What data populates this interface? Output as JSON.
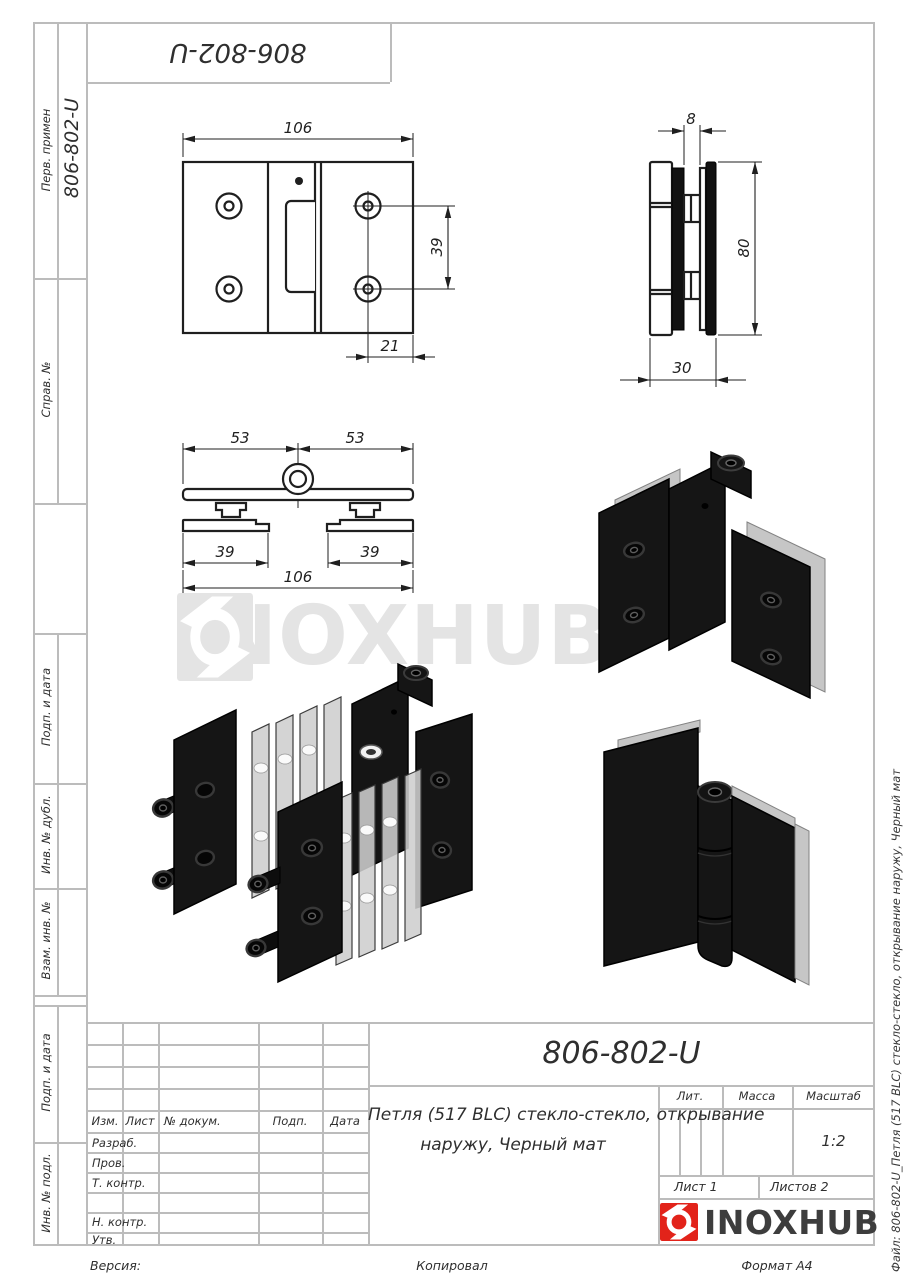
{
  "document": {
    "top_stamp": "806-802-U",
    "side_stamp": "806-802-U",
    "title_number": "806-802-U",
    "description_line1": "Петля (517 BLC) стекло-стекло, открывание",
    "description_line2": "наружу, Черный мат",
    "file_note": "Файл: 806-802-U_Петля (517 BLC) стекло-стекло, открывание наружу, Черный мат",
    "version_label": "Версия:",
    "copied_label": "Копировал",
    "format_label": "Формат A4"
  },
  "sidebar": {
    "labels": [
      "Перв. примен",
      "Справ. №",
      "Подп. и дата",
      "Инв. № дубл.",
      "Взам. инв. №",
      "Подп. и дата",
      "Инв. № подл."
    ]
  },
  "rev_table": {
    "headers": [
      "Изм.",
      "Лист",
      "№ докум.",
      "Подп.",
      "Дата"
    ],
    "rows": [
      "Разраб.",
      "Пров.",
      "Т. контр.",
      "",
      "Н. контр.",
      "Утв."
    ]
  },
  "title_block": {
    "lit": "Лит.",
    "mass": "Масса",
    "scale": "Масштаб",
    "scale_value": "1:2",
    "sheet": "Лист 1",
    "sheets": "Листов 2"
  },
  "logo": {
    "text": "INOXHUB"
  },
  "watermark": {
    "text": "INOXHUB"
  },
  "dims": {
    "front": {
      "width": "106",
      "spacing": "39",
      "offset": "21"
    },
    "side": {
      "gap": "8",
      "height": "80",
      "depth": "30"
    },
    "top": {
      "left": "53",
      "right": "53",
      "plate_left": "39",
      "plate_right": "39",
      "total": "106"
    }
  },
  "colors": {
    "brand_red": "#e2231a",
    "logo_text": "#3d3d3d",
    "frame_line": "#bcbcbc",
    "drawing_line": "#1f1f1f",
    "watermark": "#e4e4e4"
  }
}
